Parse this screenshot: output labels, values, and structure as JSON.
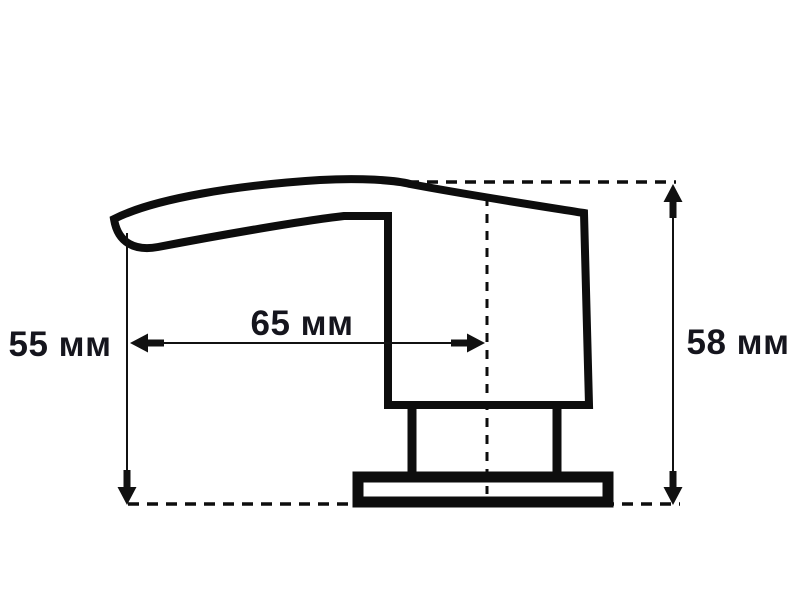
{
  "page": {
    "background": "#ffffff"
  },
  "drawing": {
    "kind": "technical-dimension-drawing",
    "dimension_labels": {
      "spout_height": "55 мм",
      "spout_reach": "65 мм",
      "overall_height": "58 мм"
    },
    "dimension_values": {
      "spout_height_mm": 55,
      "spout_reach_mm": 65,
      "overall_height_mm": 58
    },
    "unit": "мм",
    "colors": {
      "line": "#0d0d0d",
      "text": "#15151d",
      "background": "#ffffff"
    }
  }
}
